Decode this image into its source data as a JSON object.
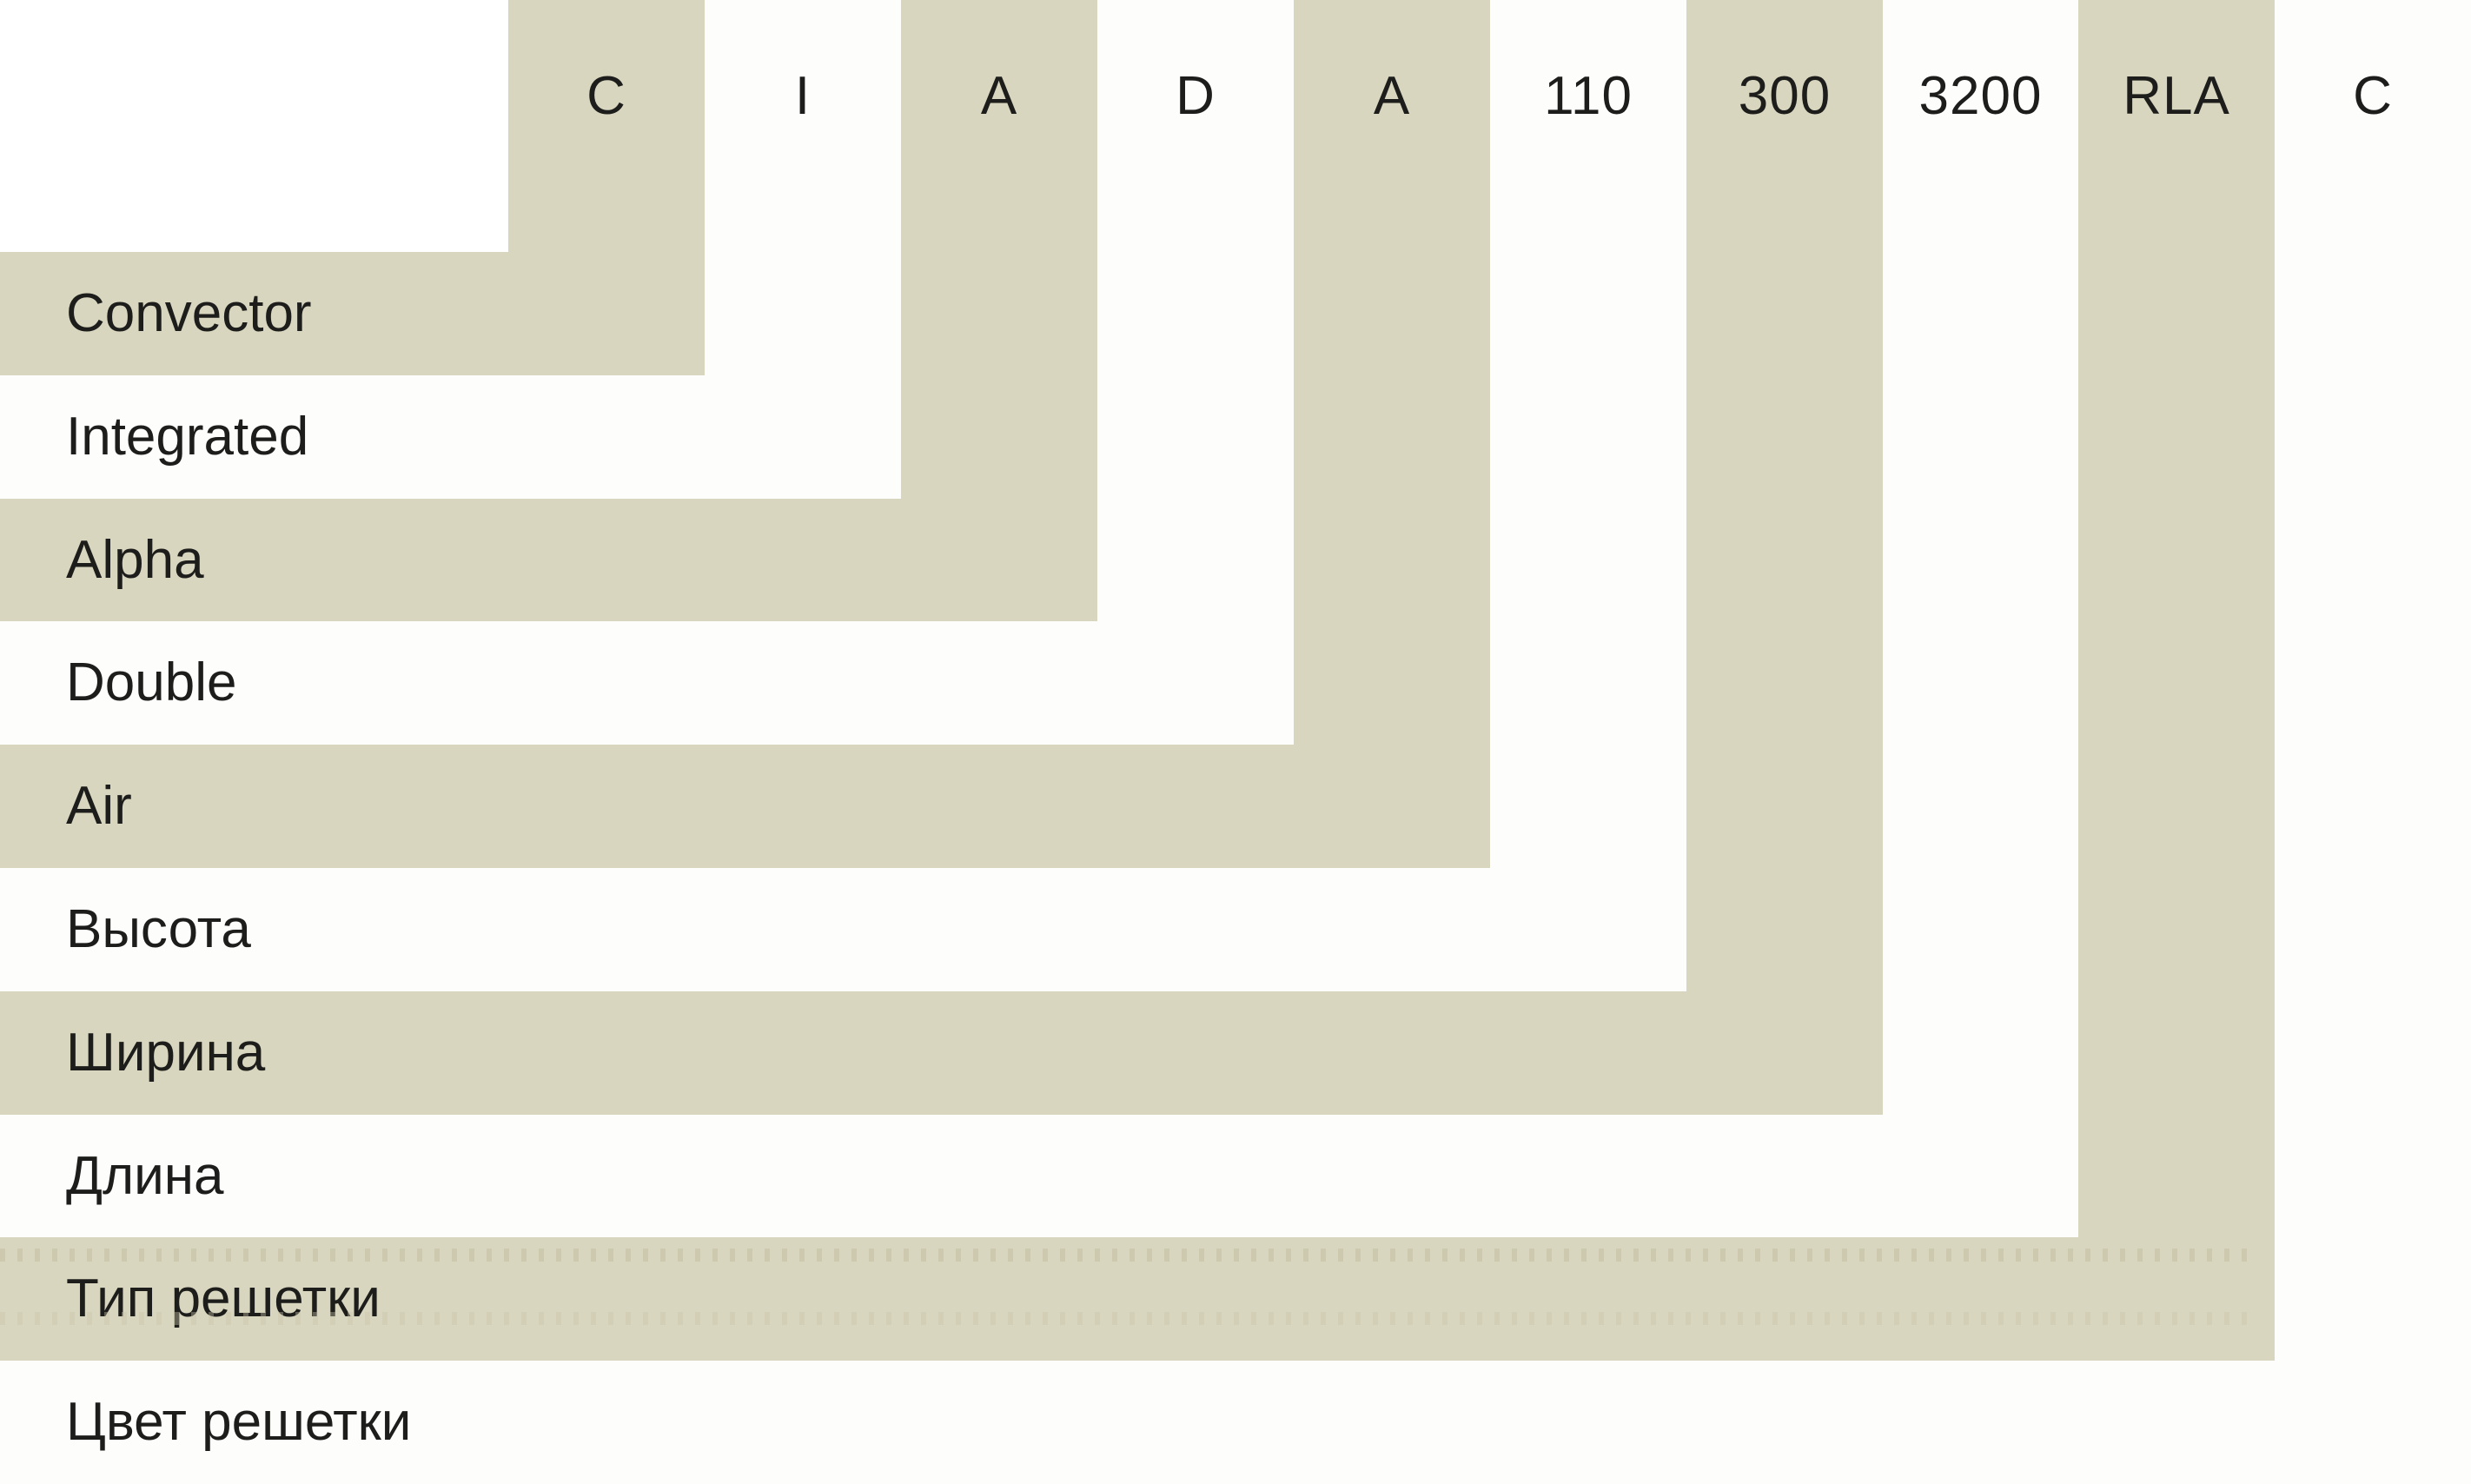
{
  "colors": {
    "band": "#d9d6bf",
    "band-alt": "#fdfdfc",
    "text": "#1d1d1b",
    "bg": "#ffffff",
    "dots": "#c9c5a9"
  },
  "steps": [
    {
      "code": "C",
      "label": "Convector"
    },
    {
      "code": "I",
      "label": "Integrated"
    },
    {
      "code": "A",
      "label": "Alpha"
    },
    {
      "code": "D",
      "label": "Double"
    },
    {
      "code": "A",
      "label": "Air"
    },
    {
      "code": "110",
      "label": "Высота"
    },
    {
      "code": "300",
      "label": "Ширина"
    },
    {
      "code": "3200",
      "label": "Длина"
    },
    {
      "code": "RLA",
      "label": "Тип решетки"
    },
    {
      "code": "C",
      "label": "Цвет решетки"
    }
  ]
}
